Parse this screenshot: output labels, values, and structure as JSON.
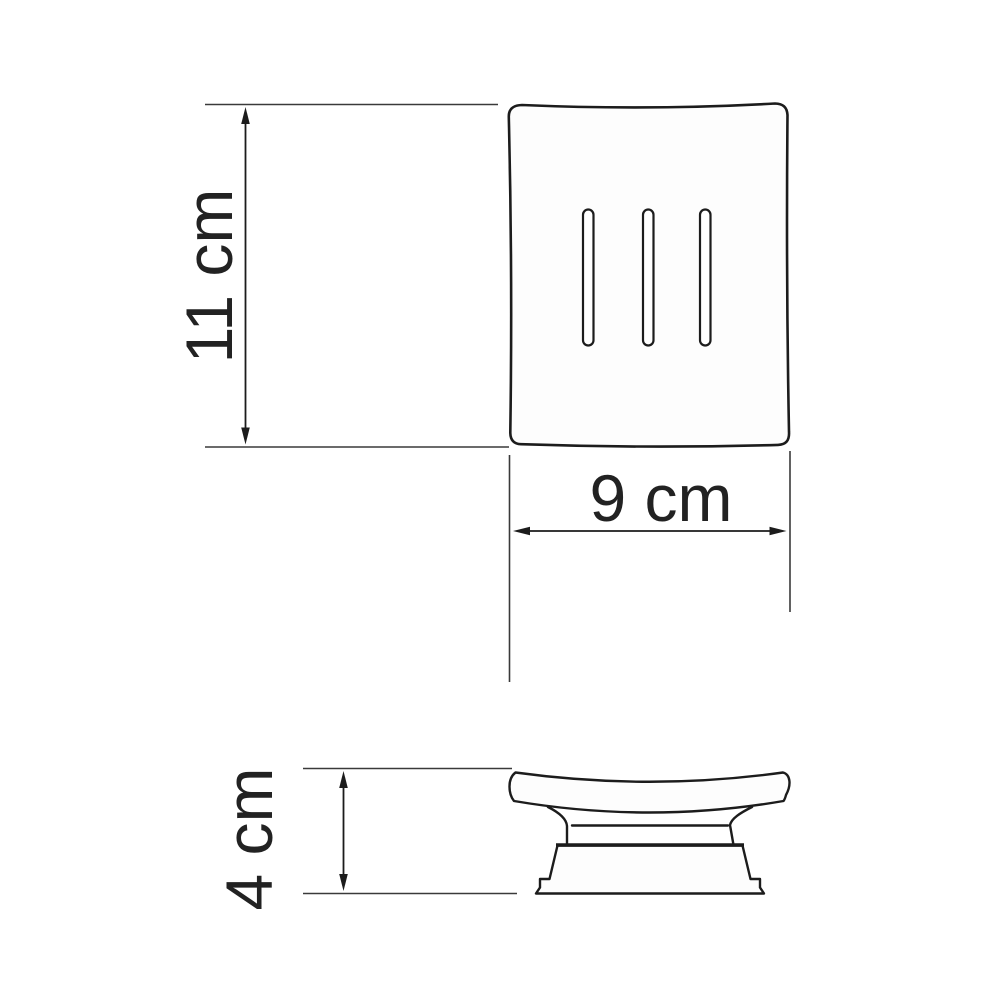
{
  "drawing": {
    "dimensions": {
      "height": {
        "label": "11 cm",
        "orientation": "vertical"
      },
      "width": {
        "label": "9 cm",
        "orientation": "horizontal"
      },
      "depth": {
        "label": "4 cm",
        "orientation": "vertical"
      }
    },
    "top_view": {
      "drain_slot_count": 3
    },
    "style": {
      "line_color": "#1c1c1c",
      "text_color": "#222222",
      "background": "#ffffff"
    }
  }
}
